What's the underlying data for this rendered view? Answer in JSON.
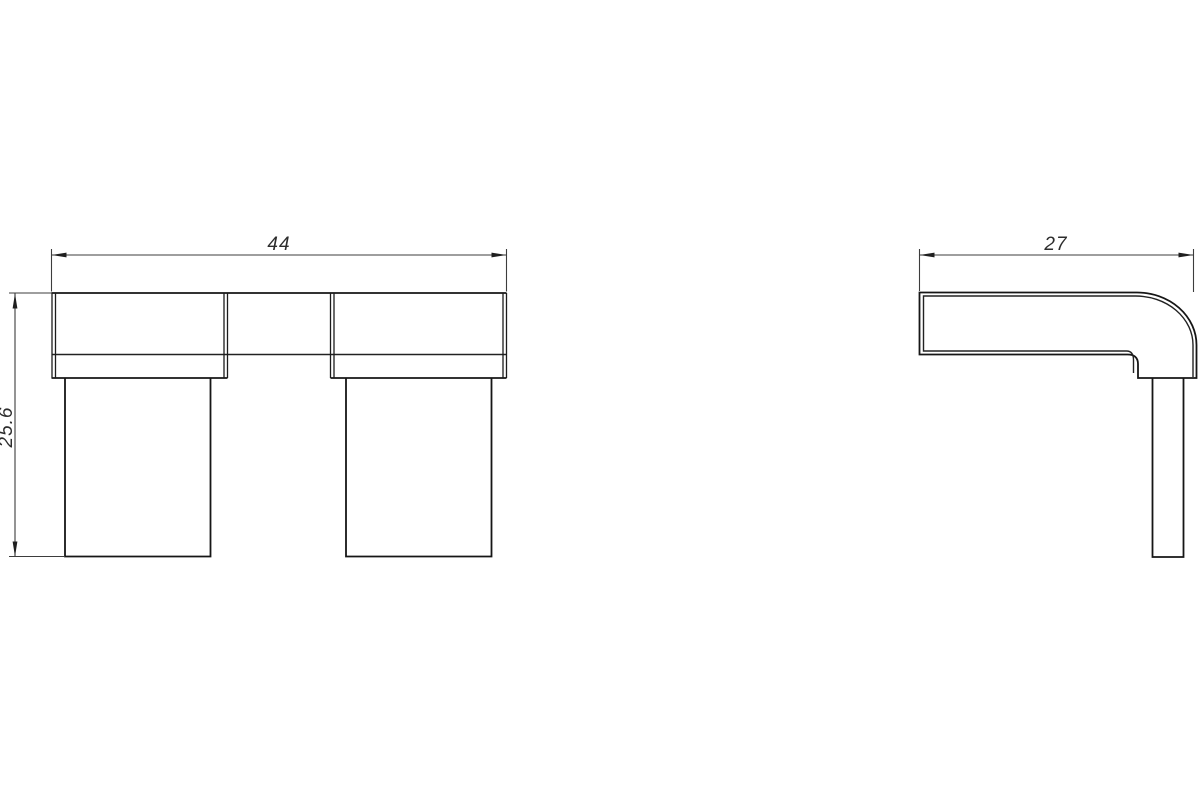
{
  "drawing": {
    "background_color": "#ffffff",
    "outline_color": "#161616",
    "dim_line_color": "#3d3d3d",
    "dim_text_color": "#2d2d2d",
    "views": {
      "front": {
        "name": "front view",
        "dimensions": {
          "width": {
            "label": "44",
            "orientation": "horizontal"
          },
          "height": {
            "label": "25.6",
            "orientation": "vertical"
          }
        }
      },
      "side": {
        "name": "side view",
        "dimensions": {
          "depth": {
            "label": "27",
            "orientation": "horizontal"
          }
        }
      }
    }
  }
}
